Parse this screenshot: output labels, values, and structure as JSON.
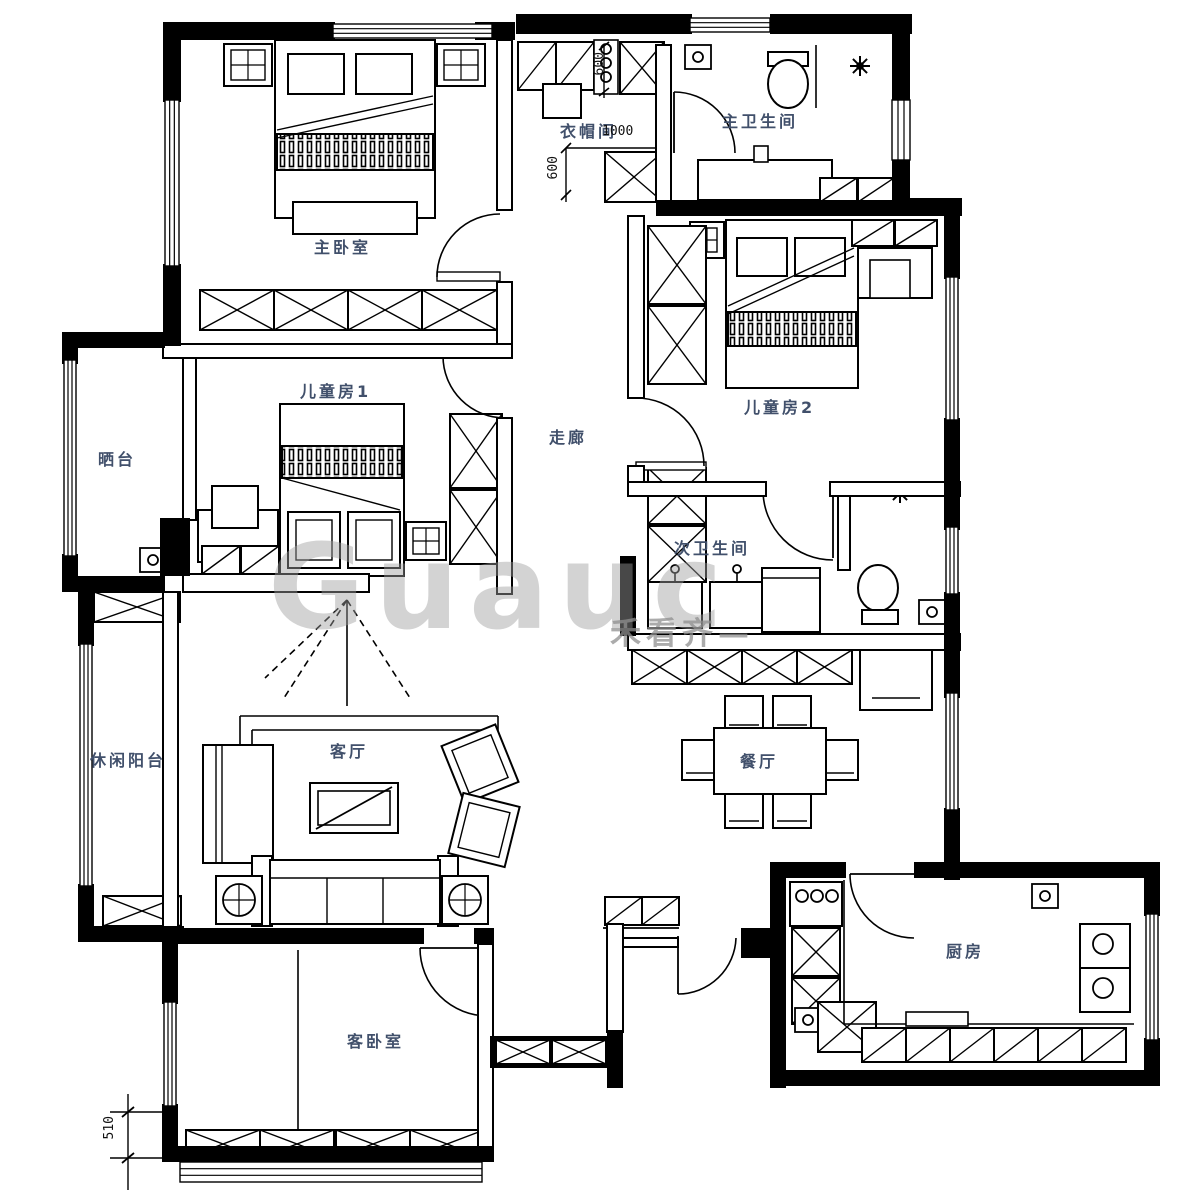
{
  "rooms": {
    "master_bedroom": {
      "label": "主卧室"
    },
    "cloakroom": {
      "label": "衣帽间"
    },
    "master_bathroom": {
      "label": "主卫生间"
    },
    "kids_room_2": {
      "label": "儿童房2"
    },
    "sun_terrace": {
      "label": "晒台"
    },
    "kids_room_1": {
      "label": "儿童房1"
    },
    "corridor": {
      "label": "走廊"
    },
    "second_bathroom": {
      "label": "次卫生间"
    },
    "leisure_balcony": {
      "label": "休闲阳台"
    },
    "living_room": {
      "label": "客厅"
    },
    "dining_room": {
      "label": "餐厅"
    },
    "kitchen": {
      "label": "厨房"
    },
    "guest_bedroom": {
      "label": "客卧室"
    }
  },
  "dimensions": {
    "cloakroom_top": "600",
    "cloakroom_width": "1000",
    "cloakroom_left": "600",
    "guest_bottom": "510"
  },
  "watermark": {
    "latin": "Guauc",
    "cjk": "禾看齐—"
  },
  "colors": {
    "wall": "#000000",
    "line": "#000000",
    "label": "#41506b",
    "watermark": "#a0a0a0"
  }
}
